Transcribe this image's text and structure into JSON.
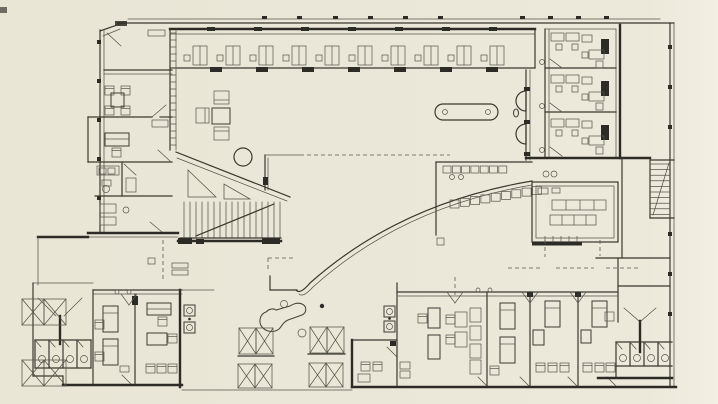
{
  "document": {
    "kind": "architectural-floor-plan",
    "medium": "scanned-print-halftone"
  },
  "palette": {
    "paper": "#ebe7d8",
    "paper_light": "#f2efe3",
    "ink_heavy": "#2c2b26",
    "ink_medium": "#44433a",
    "ink_light": "#55544a"
  },
  "symbols": {
    "gallery_desks": 10,
    "gallery_top_piers": 7,
    "gallery_bottom_piers": 7,
    "shaft_rungs": 17,
    "main_stair_treads": 17,
    "east_stair_treads": 10,
    "west_toilet_stalls": 4,
    "east_toilet_stalls": 4,
    "east_office_rooms": 3,
    "arc_seats": 9,
    "servery_seats": 7,
    "partition_bays": 12,
    "west_window_mullions": 5,
    "north_facade_ticks": 10
  },
  "features": [
    "perimeter-walls",
    "north-gallery-with-desks",
    "west-meeting-room",
    "west-office",
    "west-bathroom",
    "central-hall-lounge",
    "hall-column",
    "main-staircase",
    "east-staircase",
    "curved-wall",
    "oval-table",
    "wall-basin-niches",
    "servery-counter",
    "east-office-block",
    "refectory-long-tables",
    "west-toilet-block",
    "east-toilet-block",
    "south-west-bedrooms",
    "south-east-bedrooms",
    "south-center-office",
    "grand-piano",
    "terrace-folding-partitions",
    "section-dashed-lines"
  ]
}
